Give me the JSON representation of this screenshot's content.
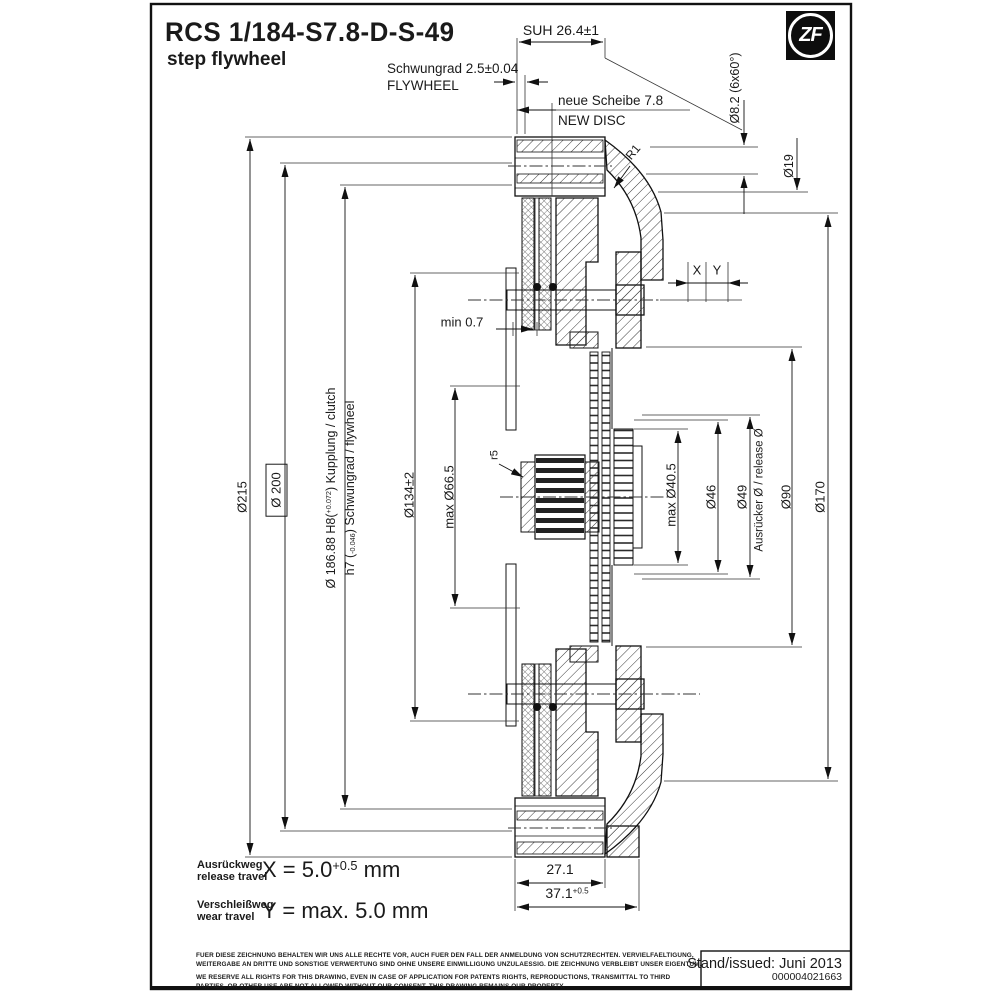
{
  "header": {
    "title": "RCS 1/184-S7.8-D-S-49",
    "subtitle": "step flywheel",
    "logo_text": "ZF"
  },
  "dims": {
    "suh": "SUH 26.4±1",
    "flywheel_de": "Schwungrad 2.5±0.04",
    "flywheel_en": "FLYWHEEL",
    "new_disc_de": "neue Scheibe 7.8",
    "new_disc_en": "NEW DISC",
    "r1": "R1",
    "hole_pattern": "Ø8.2 (6x60°)",
    "d19": "Ø19",
    "x": "X",
    "y": "Y",
    "min07": "min 0.7",
    "d215": "Ø215",
    "d200": "Ø 200",
    "d186_prefix": "Ø 186.88 H8(",
    "d186_tol": "+0.072",
    "d186_suffix": ") Kupplung / clutch",
    "h7_prefix": "h7 (",
    "h7_tol": "-0.046",
    "h7_suffix": ") Schwungrad / flywheel",
    "d134": "Ø134±2",
    "d66": "max Ø66.5",
    "r5": "r5",
    "d405": "max Ø40.5",
    "d46": "Ø46",
    "d49": "Ø49",
    "release": "Ausrücker Ø / release Ø",
    "d90": "Ø90",
    "d170": "Ø170",
    "w271": "27.1",
    "w371": "37.1",
    "w371_tol": "+0.5"
  },
  "travel": {
    "release_de": "Ausrückweg",
    "release_en": "release travel",
    "x_eq": "X = 5.0",
    "x_tol": "+0.5",
    "x_unit": "mm",
    "wear_de": "Verschleißweg",
    "wear_en": "wear travel",
    "y_eq": "Y = max. 5.0 mm"
  },
  "disclaimer": {
    "de1": "FUER DIESE ZEICHNUNG BEHALTEN WIR UNS ALLE RECHTE VOR, AUCH FUER DEN FALL DER ANMELDUNG VON SCHUTZRECHTEN. VERVIELFAELTIGUNG,",
    "de2": "WEITERGABE AN DRITTE UND SONSTIGE VERWERTUNG SIND OHNE UNSERE EINWILLIGUNG UNZULAESSIG. DIE ZEICHNUNG VERBLEIBT UNSER EIGENTUM.",
    "en1": "WE RESERVE ALL RIGHTS FOR THIS DRAWING, EVEN IN CASE OF APPLICATION FOR PATENTS RIGHTS, REPRODUCTIONS, TRANSMITTAL TO THIRD",
    "en2": "PARTIES, OR OTHER USE ARE NOT ALLOWED WITHOUT OUR CONSENT. THIS DRAWING REMAINS OUR PROPERTY."
  },
  "title_block": {
    "issued": "Stand/issued: Juni 2013",
    "doc_number": "000004021663"
  }
}
